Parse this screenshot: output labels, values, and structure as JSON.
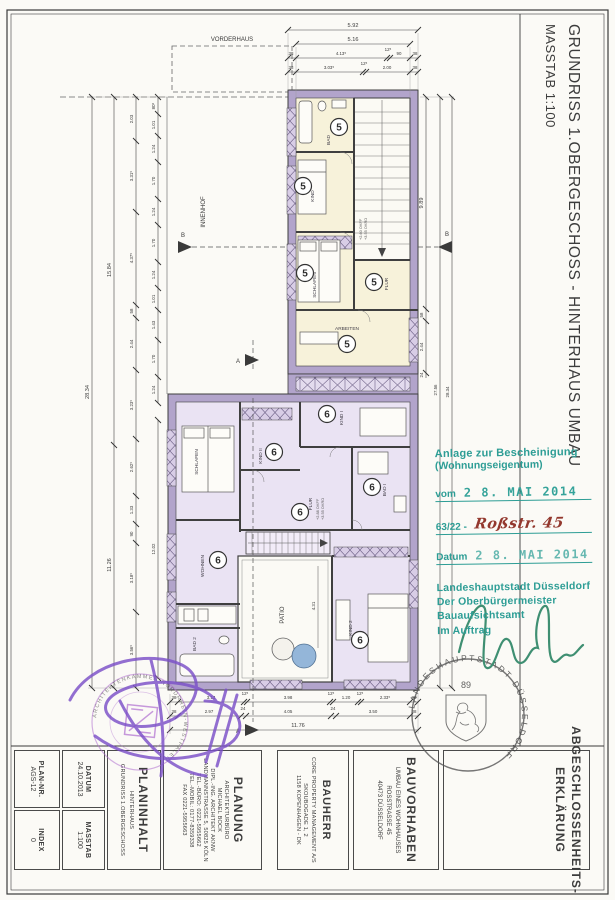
{
  "title": {
    "main": "GRUNDRISS 1.OBERGESCHOSS  -  HINTERHAUS UMBAU",
    "scale": "MASSTAB 1:100"
  },
  "plan": {
    "vorderhaus": "VORDERHAUS",
    "innenhof": "INNENHOF",
    "patio": "PATIO",
    "patio_dim": "4.31",
    "unit5": "5",
    "unit6": "6",
    "rooms5": {
      "bad": "BAD",
      "kind": "KIND",
      "flur": "FLUR",
      "schlafen": "SCHLAFEN",
      "arbeiten": "ARBEITEN"
    },
    "rooms6": {
      "kind1": "KIND I",
      "kind2": "KIND II",
      "bad1": "BAD I",
      "flur": "FLUR",
      "wohnen": "WOHNEN",
      "kind3": "KIND 2",
      "schlafen": "SCHLAFEN",
      "bad2": "BAD 2"
    },
    "level5a": "+2.60 OKFF",
    "level5b": "+3.55 OKRD",
    "level6a": "+2.88 OKFF",
    "level6b": "+3.55 OKRD",
    "sectionA": "A",
    "sectionB": "B"
  },
  "dims": {
    "top1": "5.92",
    "top2": "5.16",
    "top3": [
      "38",
      "4.13⁵",
      "12⁵",
      "90",
      "38"
    ],
    "top4": [
      "38",
      "3.03⁵",
      "12⁵",
      "2.00",
      "38"
    ],
    "left1": "28.34",
    "left2": [
      "15.84",
      "11.26"
    ],
    "left3": [
      "2.03",
      "3.31⁵",
      "4.37⁵",
      "58",
      "2.44",
      "3.23⁵",
      "2.62⁵",
      "1.33",
      "90",
      "3.18⁵",
      "3.56⁵"
    ],
    "left4": [
      "80⁵",
      "1.01",
      "1.24",
      "1.70",
      "1.24",
      "1.70",
      "1.24",
      "1.01",
      "1.43",
      "1.70",
      "1.24"
    ],
    "left5": "12.02",
    "right1": "9.89",
    "right2": [
      "58",
      "2.44",
      "24"
    ],
    "right3": "27.56",
    "right4": "28.34",
    "bottom1": [
      "38",
      "3.13",
      "12⁵",
      "3.98",
      "12⁵",
      "1.20",
      "12⁵",
      "2.33⁵",
      "38"
    ],
    "bottom2": [
      "38",
      "2.97",
      "24",
      "4.05",
      "24",
      "3.50",
      "38"
    ],
    "bottom3": "11.76"
  },
  "stamps": {
    "green": {
      "l1": "Anlage zur Bescheinigung",
      "l2": "(Wohnungseigentum)",
      "vom": "vom",
      "vom_date": "2 8. MAI  2014",
      "ref": "63/22 -",
      "street": "Roßstr. 45",
      "datum": "Datum",
      "datum_date": "2 8. MAI  2014",
      "auth1": "Landeshauptstadt Düsseldorf",
      "auth2": "Der Oberbürgermeister",
      "auth3": "Bauaufsichtsamt",
      "auth4": "Im Auftrag"
    },
    "round": {
      "ring": "LANDESHAUPTSTADT  DÜSSELDORF",
      "num": "89"
    },
    "architect": {
      "ring": "ARCHITEKTENKAMMER NORDRHEIN-WESTFALEN"
    }
  },
  "titleblock": {
    "plannr_label": "PLAN-NR.",
    "plannr": "AGS-12",
    "index_label": "INDEX",
    "index": "0",
    "datum_label": "DATUM",
    "datum": "24.10.2013",
    "masstab_label": "MASSTAB",
    "masstab": "1:100",
    "planinhalt_label": "PLANINHALT",
    "planinhalt1": "HINTERHAUS",
    "planinhalt2": "GRUNDRISS 1.OBERGESCHOSS",
    "planung_label": "PLANUNG",
    "planung": [
      "ARCHITEKTURBÜRO",
      "MICHAEL BOCK",
      "DIPL.-ING. ARCHITEKT AKNW",
      "LANDMANNSTRASSE 5, 50825 KÖLN",
      "TEL.-BÜRO: 0221-5955662",
      "TEL.-MOBIL: 0177-8359338",
      "FAX 0221-5955663"
    ],
    "bauherr_label": "BAUHERR",
    "bauherr": [
      "CORE PROPERTY MANAGEMENT A/S",
      "SKOUBOGADE 1, 2",
      "1158 KOPENHAGEN - DK"
    ],
    "bauvorhaben_label": "BAUVORHABEN",
    "bauvorhaben": [
      "UMBAU EINES WOHNHAUSES",
      "ROSSTRASSE 45",
      "40473 DÜSSELDORF"
    ],
    "abg1": "ABGESCHLOSSENHEITS-",
    "abg2": "ERKLÄRUNG"
  }
}
